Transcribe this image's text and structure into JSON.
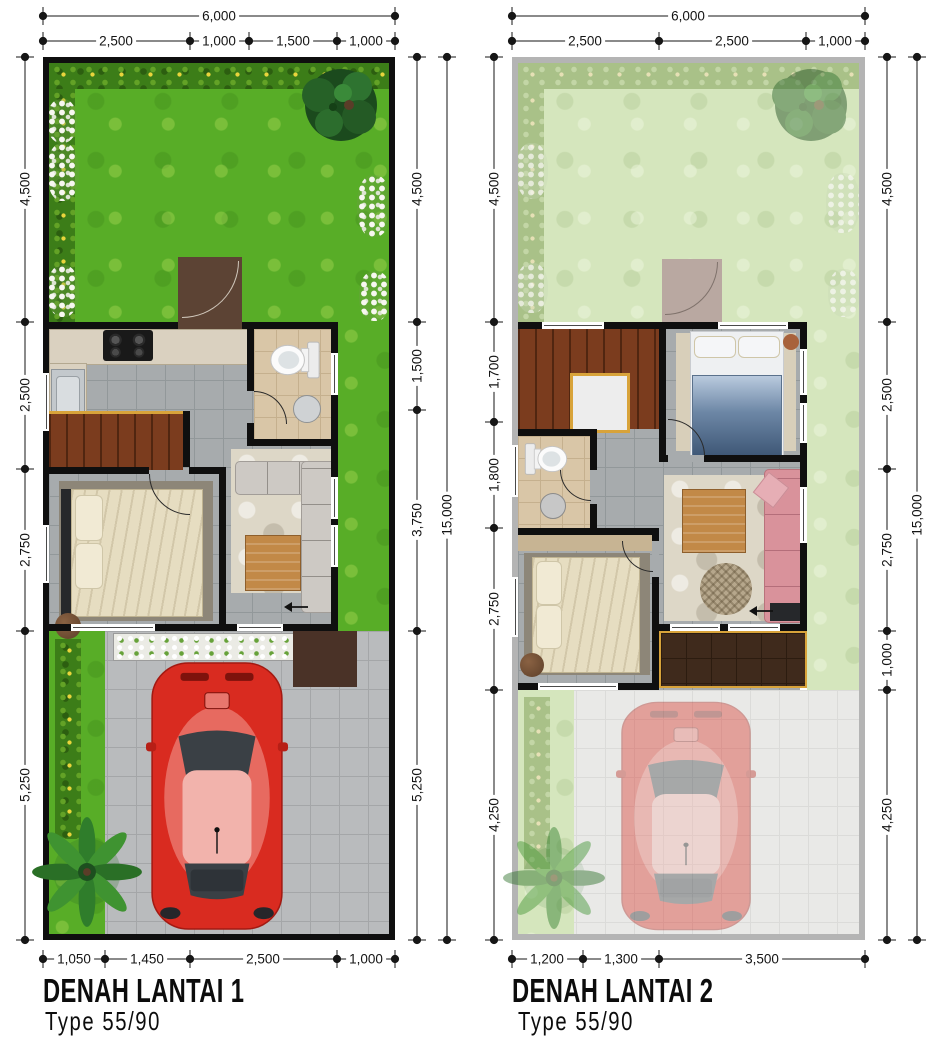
{
  "sheet": {
    "background": "#ffffff"
  },
  "plans": [
    {
      "title": "DENAH LANTAI 1",
      "subtitle": "Type 55/90",
      "dimensions": {
        "top_total": "6,000",
        "top_segments": [
          "2,500",
          "1,000",
          "1,500",
          "1,000"
        ],
        "left_segments": [
          "4,500",
          "2,500",
          "2,750",
          "5,250"
        ],
        "right_segments": [
          "4,500",
          "1,500",
          "3,750",
          "5,250"
        ],
        "right_total": "15,000",
        "bottom_segments": [
          "1,050",
          "1,450",
          "2,500",
          "1,000"
        ]
      },
      "features": [
        "garden",
        "hedge",
        "tree",
        "entry-terrace",
        "kitchen",
        "stove",
        "sink",
        "bathroom",
        "toilet",
        "stairs",
        "bedroom",
        "double-bed",
        "living-room",
        "corner-sofa",
        "coffee-table",
        "carport-driveway",
        "car",
        "palm-tree",
        "planter"
      ]
    },
    {
      "title": "DENAH LANTAI 2",
      "subtitle": "Type 55/90",
      "dimensions": {
        "top_total": "6,000",
        "top_segments": [
          "2,500",
          "2,500",
          "1,000"
        ],
        "left_segments": [
          "4,500",
          "1,700",
          "1,800",
          "2,750",
          "4,250"
        ],
        "right_segments": [
          "4,500",
          "2,500",
          "2,750",
          "1,000",
          "4,250"
        ],
        "right_total": "15,000",
        "bottom_segments": [
          "1,200",
          "1,300",
          "3,500"
        ]
      },
      "features": [
        "staircase",
        "landing",
        "bathroom",
        "toilet",
        "wash-basin",
        "bedroom-1",
        "blue-bed",
        "bedroom-2",
        "cream-bed",
        "family-room",
        "pink-sofa",
        "coffee-table",
        "ottoman",
        "balcony",
        "faded-ground-level",
        "car",
        "palm-tree"
      ]
    }
  ],
  "colors": {
    "lawn": "#58ad27",
    "floor_tile": "#a7abad",
    "stair_wood": "#7b3c1e",
    "car_red": "#d92b20",
    "sofa_pink": "#d9929b",
    "balcony_wood": "#3f2a1c",
    "gold_trim": "#d8a33a"
  }
}
